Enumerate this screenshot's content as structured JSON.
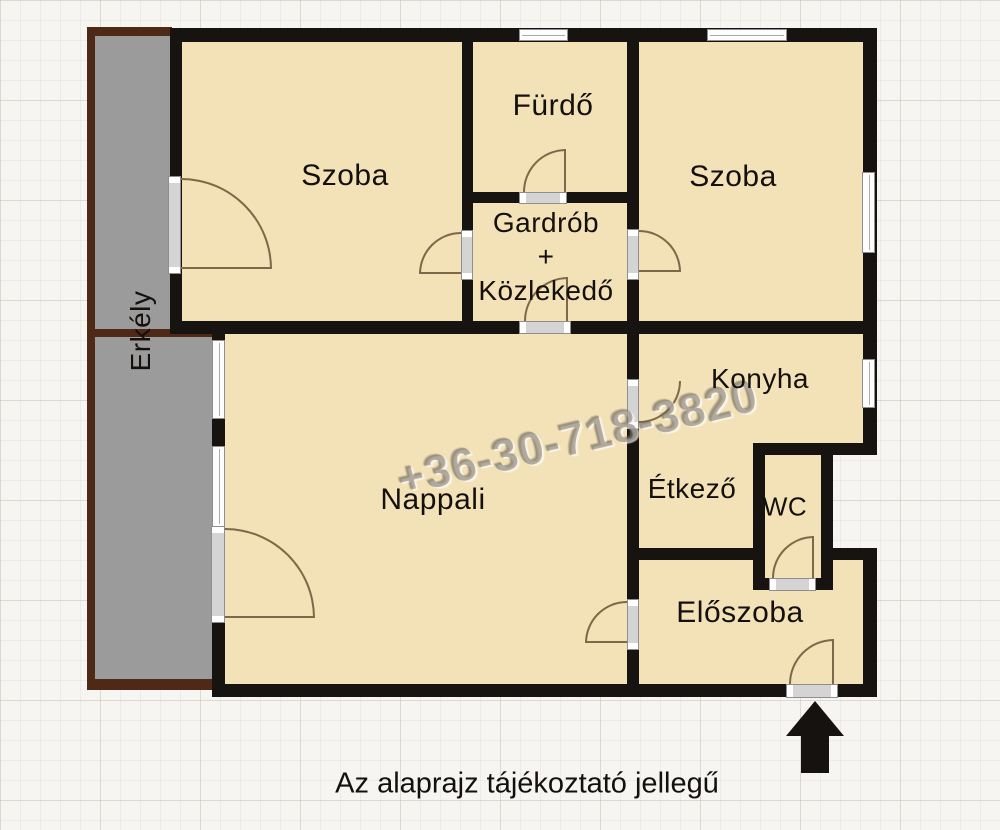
{
  "rooms": {
    "szoba_left": "Szoba",
    "furdo": "Fürdő",
    "gardrob_line1": "Gardrób",
    "gardrob_line2": "+",
    "gardrob_line3": "Közlekedő",
    "szoba_right": "Szoba",
    "konyha": "Konyha",
    "nappali": "Nappali",
    "etkezo": "Étkező",
    "wc": "WC",
    "eloszoba": "Előszoba",
    "erkely": "Erkély"
  },
  "watermark": "+36-30-718-3820",
  "caption": "Az alaprajz tájékoztató jellegű",
  "icons": {
    "entrance_arrow": "up-arrow"
  },
  "colors": {
    "floor": "#f3e1b8",
    "wall": "#171310",
    "balcony_fill": "#9b9b9b",
    "balcony_border": "#4e2a16",
    "paper": "#f6f5f2",
    "door_arc": "#7d6849",
    "watermark_gray": "#80786e"
  }
}
